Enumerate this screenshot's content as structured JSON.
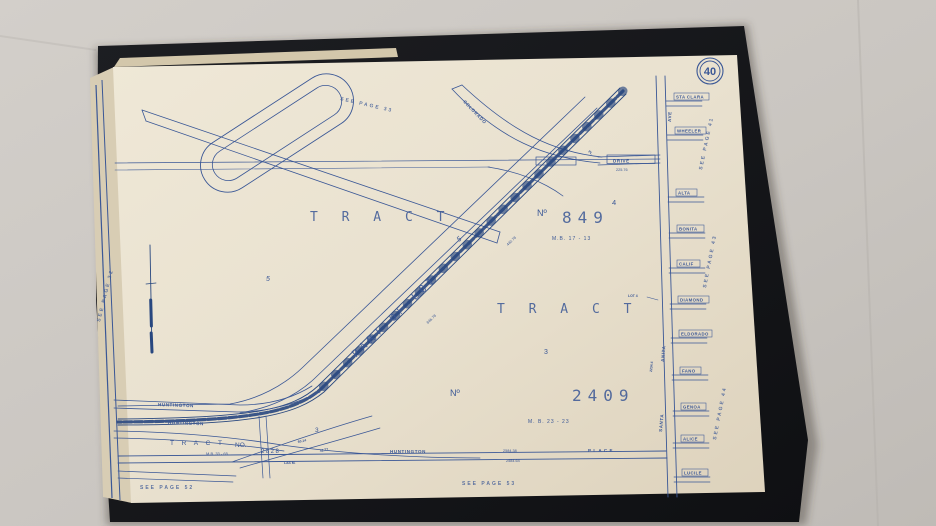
{
  "photo": {
    "cloth_color": "#cbc7c2",
    "cover_color": "#16171a",
    "paper_color": "#e9e1cf",
    "ink_color": "#3a5796"
  },
  "page": {
    "number": "40",
    "references": {
      "top": "SEE  PAGE  33",
      "left": "SEE PAGE 32",
      "bottom_left": "SEE   PAGE   52",
      "bottom_right": "SEE   PAGE   53",
      "right_upper": "SEE PAGE 41",
      "right_middle": "SEE PAGE 43",
      "right_lower": "SEE PAGE 44"
    }
  },
  "map": {
    "tract_849": {
      "tract": "T R A C T",
      "no": "Nº",
      "number": "849",
      "lot_sup": "4",
      "map_book": "M.B.  17 - 13"
    },
    "tract_2409": {
      "tract": "T R A C T",
      "no": "Nº",
      "number": "2409",
      "map_book": "M. B.    23   -  23",
      "lot": "3"
    },
    "tract_2828": {
      "tract": "T R A C T",
      "no": "NO.",
      "map_book": "M.B. 33 - 65",
      "number": "2828"
    },
    "part_of_lot": {
      "label": "PART  OF  LOT",
      "lot": "5"
    },
    "lot_labels": {
      "lot4": "LOT 4",
      "lot5_area": "5",
      "lot3_area": "3"
    },
    "roads": {
      "colorado": {
        "name": "COLORADO",
        "suffix": "PL"
      },
      "drive": {
        "name": "DRIVE",
        "dim": "225.76"
      },
      "huntington_upper": "HUNTINGTON",
      "huntington_rail": "HUNTINGTON",
      "huntington_place": {
        "name": "HUNTINGTON",
        "suffix": "P L A C E",
        "dim_top": "2584.38",
        "dim_bottom": "2584.64"
      },
      "santa_anita": {
        "first": "SANTA",
        "last": "ANITA",
        "ave": "AVE",
        "dim": "2234.4"
      }
    },
    "right_streets": [
      {
        "label": "STA CLARA"
      },
      {
        "label": "WHEELER"
      },
      {
        "label": "ALTA"
      },
      {
        "label": "BONITA"
      },
      {
        "label": "CALIF"
      },
      {
        "label": "DIAMOND"
      },
      {
        "label": "ELDORADO"
      },
      {
        "label": "FANO"
      },
      {
        "label": "GENOA"
      },
      {
        "label": "ALICE"
      },
      {
        "label": "LUCILE"
      }
    ],
    "small_dims": {
      "rail_1": "846.78",
      "rail_2": "440.78",
      "junction_1": "60.14",
      "junction_2": "42.77",
      "junction_3": "LAS M."
    }
  }
}
